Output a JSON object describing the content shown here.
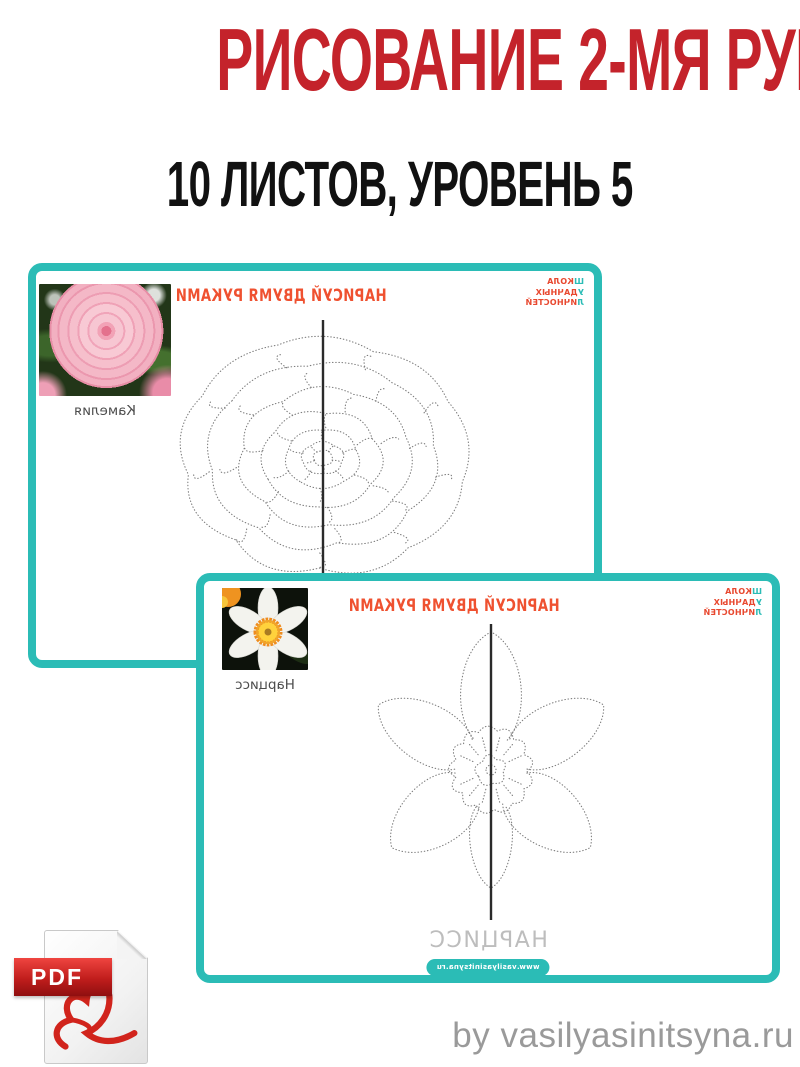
{
  "header": {
    "title": "РИСОВАНИЕ 2-МЯ РУКАМИ",
    "subtitle": "10 ЛИСТОВ, УРОВЕНЬ 5"
  },
  "colors": {
    "accent_teal": "#2BBCB6",
    "header_red": "#C4232B",
    "worksheet_orange": "#EF5130",
    "logo_red": "#E8482F"
  },
  "worksheets": [
    {
      "title": "НАРИСУЙ ДВУМЯ РУКАМИ",
      "flower_label": "Камелия",
      "logo": [
        {
          "accent": "Ш",
          "rest": "КОЛА"
        },
        {
          "accent": "У",
          "rest": "ДАЧНЫХ"
        },
        {
          "accent": "Л",
          "rest": "ИЧНОСТЕЙ"
        }
      ]
    },
    {
      "title": "НАРИСУЙ ДВУМЯ РУКАМИ",
      "flower_label": "Нарцисс",
      "logo": [
        {
          "accent": "Ш",
          "rest": "КОЛА"
        },
        {
          "accent": "У",
          "rest": "ДАЧНЫХ"
        },
        {
          "accent": "Л",
          "rest": "ИЧНОСТЕЙ"
        }
      ],
      "bottom_word": "НАРЦИСС",
      "website": "www.vasilyasinitsyna.ru"
    }
  ],
  "pdf_badge": {
    "label": "PDF"
  },
  "footer": {
    "credit": "by vasilyasinitsyna.ru"
  }
}
